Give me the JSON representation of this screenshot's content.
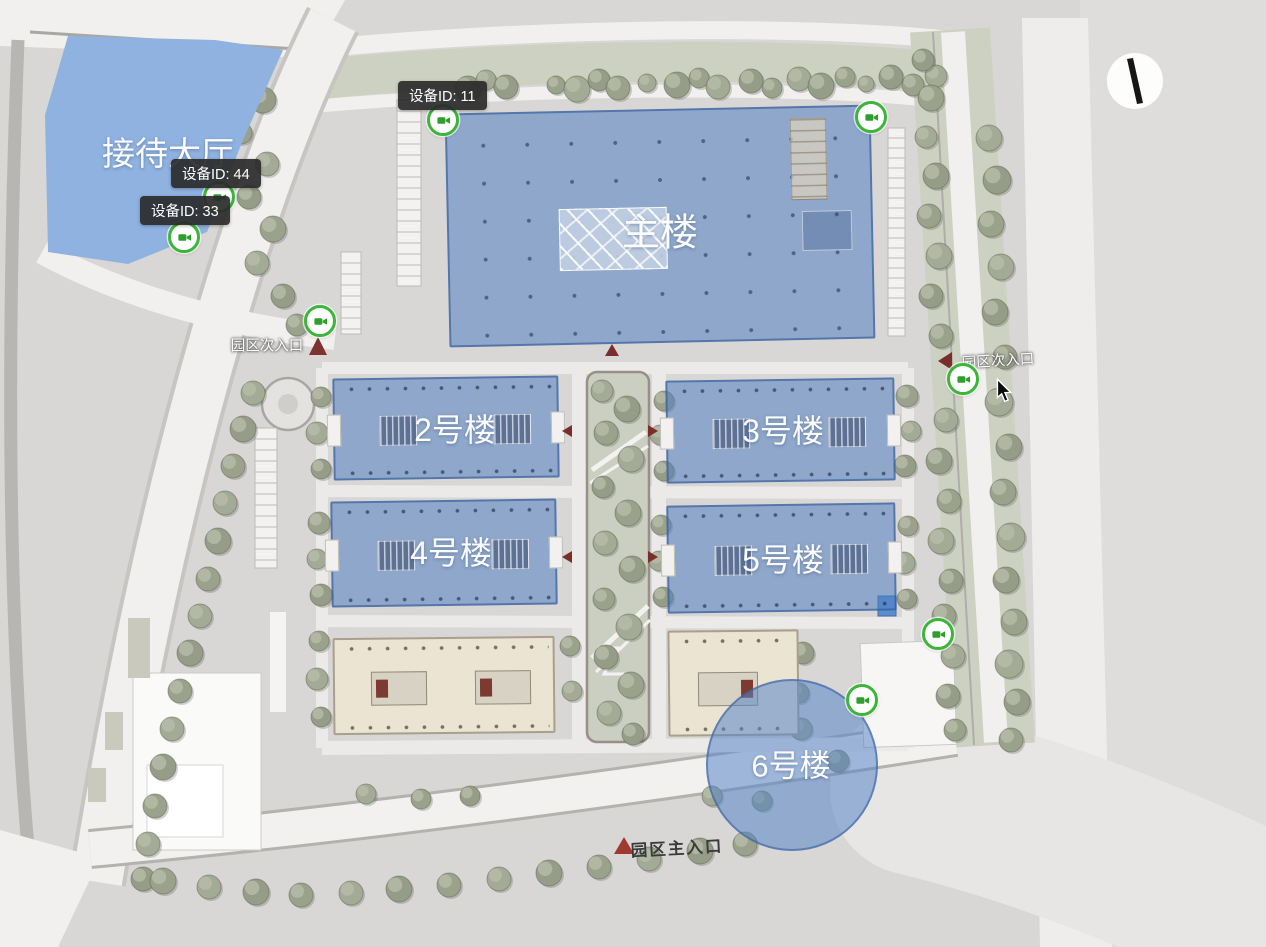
{
  "labels": {
    "reception": "接待大厅",
    "main_building": "主楼",
    "building_2": "2号楼",
    "building_3": "3号楼",
    "building_4": "4号楼",
    "building_5": "5号楼",
    "building_6": "6号楼"
  },
  "entrances": {
    "west_secondary": "园区次入口",
    "east_secondary": "园区次入口",
    "south_main": "园区主入口"
  },
  "tooltips": {
    "t11": "设备ID: 11",
    "t44": "设备ID: 44",
    "t33": "设备ID: 33"
  },
  "device_markers": {
    "icon": "camera-icon",
    "count": 8,
    "marker_color": "#3cb53a"
  },
  "colors": {
    "highlight_blue": "rgba(82,127,193,0.55)",
    "reception_blue": "#8fb2e0",
    "tooltip_bg": "#2a2a2a",
    "entrance_arrow_red": "#7a2e2a",
    "tree_green": "#9aa28c",
    "road_white": "#f1f0ee",
    "map_base": "#d8d7d5"
  }
}
